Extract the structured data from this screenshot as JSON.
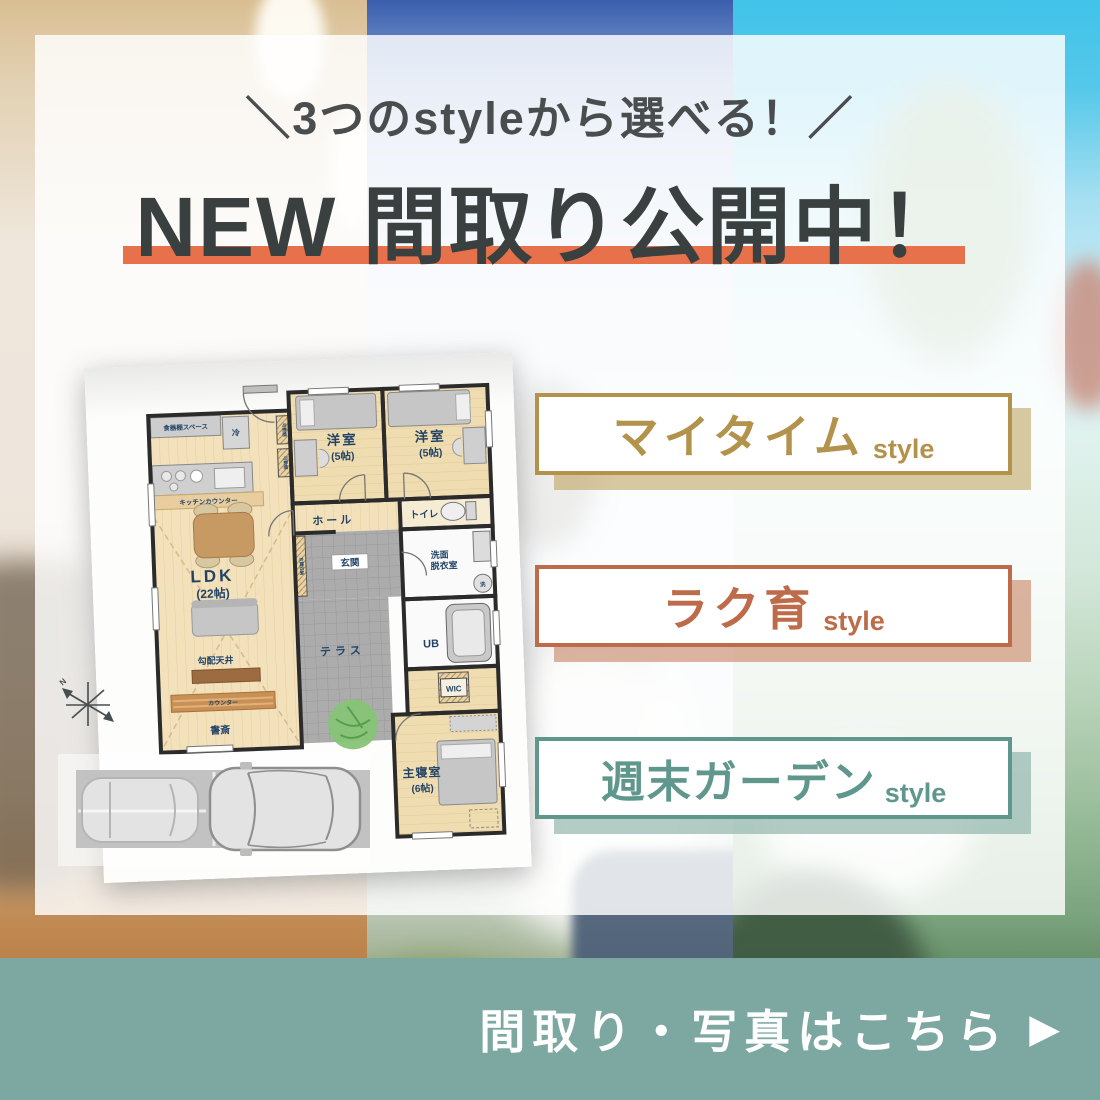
{
  "header": {
    "tagline": "＼3つのstyleから選べる！／",
    "title": "NEW 間取り公開中！"
  },
  "style_buttons": [
    {
      "label": "マイタイム",
      "suffix": "style",
      "color": "#B3924B"
    },
    {
      "label": "ラク育",
      "suffix": "style",
      "color": "#BE6B4A"
    },
    {
      "label": "週末ガーデン",
      "suffix": "style",
      "color": "#5F978D"
    }
  ],
  "cta": {
    "label": "間取り・写真はこちら",
    "arrow": "▶"
  },
  "colors": {
    "title_underline": "#E7714B",
    "cta_bar": "#7DA7A1",
    "title_text": "#3A403F"
  },
  "floorplan": {
    "labels": {
      "dish_shelf_space": "食器棚スペース",
      "fridge": "冷",
      "kitchen_counter": "キッチンカウンター",
      "movable_shelf": "可動棚",
      "western_room": "洋室",
      "western_room_size": "(5帖)",
      "hall": "ホール",
      "toilet": "トイレ",
      "entrance": "玄関",
      "entrance_storage": "玄関収納",
      "washroom_line1": "洗面",
      "washroom_line2": "脱衣室",
      "washing_machine": "洗",
      "ldk": "LDK",
      "ldk_size": "(22帖)",
      "sloped_ceiling": "勾配天井",
      "counter": "カウンター",
      "study": "書斎",
      "terrace": "テラス",
      "unit_bath": "UB",
      "wic": "WIC",
      "master_bedroom": "主寝室",
      "master_bedroom_size": "(6帖)",
      "compass_north": "N"
    }
  }
}
